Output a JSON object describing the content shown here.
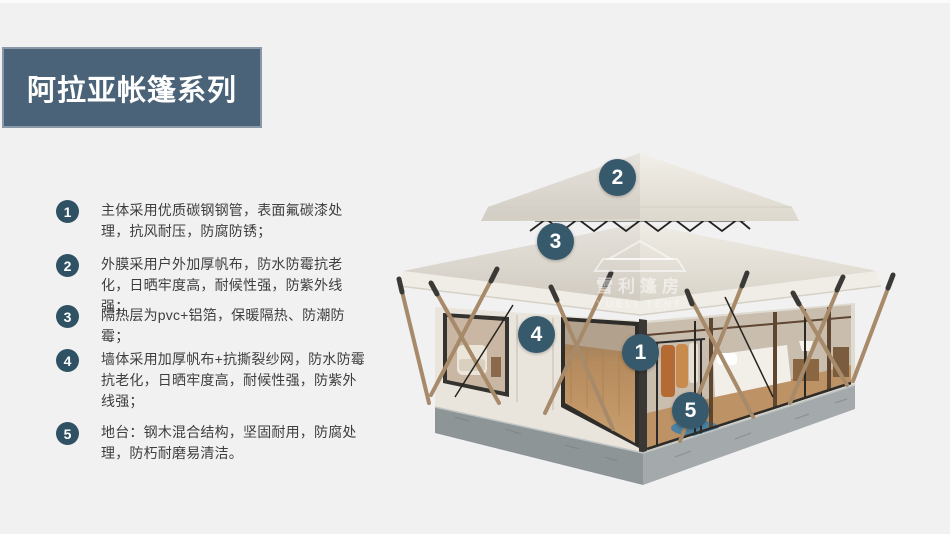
{
  "header": {
    "title": "阿拉亚帐篷系列"
  },
  "features": [
    {
      "num": "1",
      "text": "主体采用优质碳钢钢管，表面氟碳漆处理，抗风耐压，防腐防锈；"
    },
    {
      "num": "2",
      "text": "外膜采用户外加厚帆布，防水防霉抗老化，日晒牢度高，耐候性强，防紫外线强；"
    },
    {
      "num": "3",
      "text": "隔热层为pvc+铝箔，保暖隔热、防潮防霉；"
    },
    {
      "num": "4",
      "text": "墙体采用加厚帆布+抗撕裂纱网，防水防霉抗老化，日晒牢度高，耐候性强，防紫外线强；"
    },
    {
      "num": "5",
      "text": "地台：钢木混合结构，坚固耐用，防腐处理，防朽耐磨易清洁。"
    }
  ],
  "illustration": {
    "callouts": [
      {
        "num": "1"
      },
      {
        "num": "2"
      },
      {
        "num": "3"
      },
      {
        "num": "4"
      },
      {
        "num": "5"
      }
    ],
    "watermark": {
      "cn": "雪利篷房",
      "en": "YUELI TENT"
    }
  },
  "colors": {
    "background": "#f1f1f2",
    "banner": "#4b6378",
    "list_badge": "#2e5164",
    "image_badge": "#37596c",
    "roof_canvas": "#eae6de",
    "base_concrete": "#8e9597"
  }
}
